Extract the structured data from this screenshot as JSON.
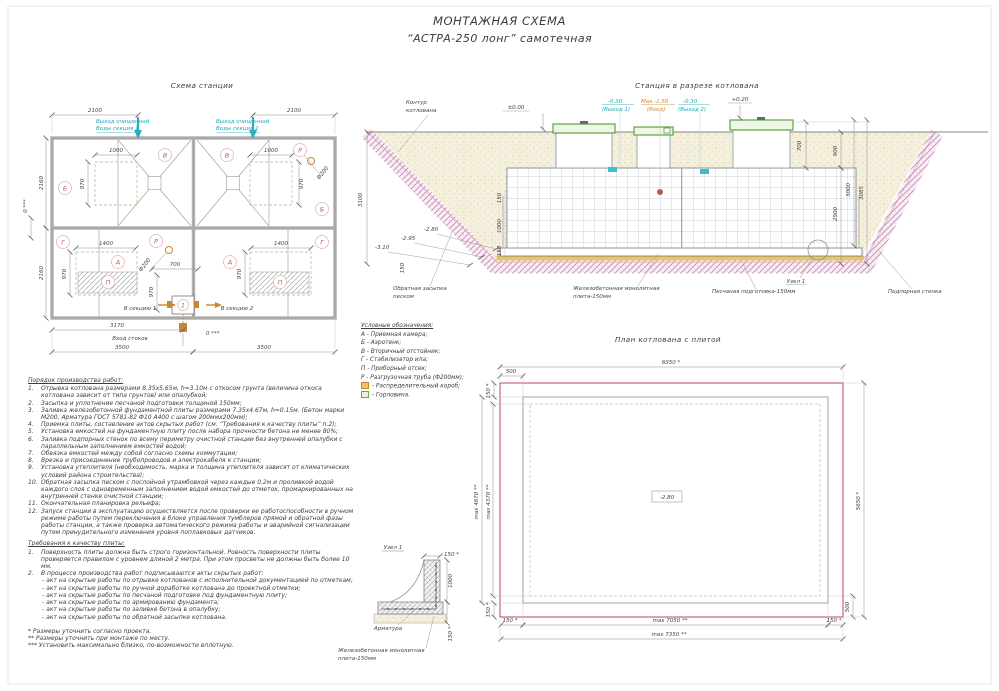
{
  "title": {
    "line1": "МОНТАЖНАЯ СХЕМА",
    "line2": "“АСТРА-250 лонг” самотечная"
  },
  "scheme": {
    "heading": "Схема станции",
    "dim_2100_left": "2100",
    "dim_2100_right": "2100",
    "outlet1_l1": "Выход очищенной",
    "outlet1_l2": "Воды секция 1",
    "outlet2_l1": "Выход очищенной",
    "outlet2_l2": "Воды секция 2",
    "dim_2160_top": "2160",
    "dim_2160_bottom": "2160",
    "dim_0_left": "0 ***",
    "dim_1000_l": "1000",
    "dim_1000_r": "1000",
    "dim_970_tl": "970",
    "dim_970_tr": "970",
    "dim_970_bl": "970",
    "dim_970_br": "970",
    "dim_970_c": "970",
    "dim_1400_l": "1400",
    "dim_1400_r": "1400",
    "dim_700": "700",
    "phi200_top": "Ф200",
    "phi200_bottom": "Ф200",
    "letters": {
      "B_l": "Б",
      "V_l": "В",
      "V_r": "В",
      "B_r": "Б",
      "R_t": "Р",
      "G_l": "Г",
      "A_l": "А",
      "P_l": "П",
      "A_r": "А",
      "G_r": "Г",
      "P_r": "П",
      "R_b": "Р",
      "one": "1"
    },
    "to_section1": "В секцию 1",
    "to_section2": "В секцию 2",
    "dim_3170": "3170",
    "inlet": "Вход стоков",
    "dim_0_bottom": "0 ***",
    "dim_3500_l": "3500",
    "dim_3500_r": "3500"
  },
  "section": {
    "heading": "Станция в разрезе котлована",
    "contour_l1": "Контур",
    "contour_l2": "котлована",
    "elev_000": "±0.00",
    "out1_l1": "-0.30",
    "out1_l2": "(Выход 1)",
    "inlet_l1": "Мах.-1.50",
    "inlet_l2": "(Вход)",
    "out2_l1": "-0.30",
    "out2_l2": "(Выход 2)",
    "elev_020": "+0.20",
    "dim_700": "700",
    "dim_900": "900",
    "dim_2900": "2900",
    "dim_3000": "3000",
    "dim_3085": "3085",
    "dim_3100": "3100",
    "elev_280": "-2.80",
    "elev_295": "-2.95",
    "elev_310": "-3.10",
    "dim_150_left": "150",
    "dim_150_a": "150",
    "dim_1000": "1000",
    "dim_150_b": "150",
    "backfill_l1": "Обратная засыпка",
    "backfill_l2": "песком",
    "slab_l1": "Железобетонная монолитная",
    "slab_l2": "плита-150мм",
    "sandprep": "Песчаная подготовка-150мм",
    "wall": "Подпорная стенка",
    "node_ref": "Узел 1"
  },
  "legend": {
    "heading": "Условные обозначения:",
    "items": [
      "А  -  Приемная камера;",
      "Б  -  Аэротенк;",
      "В  -  Вторичный отстойник;",
      "Г  -  Стабилизатор ила;",
      "П  -  Приборный отсек;",
      "Р  -  Разгрузочная труба (Ф200мм);"
    ],
    "box_item": "-  Распределительный короб;",
    "neck_item": "-  Горловина."
  },
  "plan": {
    "heading": "План котлована с плитой",
    "dim_8350": "8350 *",
    "dim_500_top": "500",
    "dim_150_tl": "150 *",
    "dim_4670": "max 4670 **",
    "dim_4370": "max 4370 **",
    "dim_150_bl": "150 *",
    "dim_5650": "5650 *",
    "dim_500_right": "500",
    "elev": "-2.80",
    "dim_150_b1": "150 *",
    "dim_7050": "max 7050 **",
    "dim_150_b2": "150 *",
    "dim_7350": "max 7350 **"
  },
  "node": {
    "heading": "Узел 1",
    "dim_150_top": "150 *",
    "dim_1000": "1000",
    "dim_150_right": "150 *",
    "rebar": "Арматура",
    "slab_l1": "Железобетонная монолитная",
    "slab_l2": "плита-150мм"
  },
  "procedure": {
    "heading": "Порядок производства работ:",
    "items": [
      {
        "n": "1.",
        "t": "Отрывка котлована размерами 8.35х5.65м, h=3.10м с откосом грунта (величина откоса котлована зависит от типа грунтов) или опалубкой;"
      },
      {
        "n": "2.",
        "t": "Засыпка и уплотнение песчаной подготовки толщиной 150мм;"
      },
      {
        "n": "3.",
        "t": "Заливка железобетонной фундаментной плиты размерами 7.35х4.67м, h=0.15м. (Бетон марки М200, Арматура ГОСТ 5781-82 Ф10 А400 с шагом 200ммх200мм);"
      },
      {
        "n": "4.",
        "t": "Приемка плиты, составление актов скрытых работ (см. “Требования к качеству плиты” п.2);"
      },
      {
        "n": "5.",
        "t": "Установка емкостей на фундаментную плиту после набора прочности бетона не менее 80%;"
      },
      {
        "n": "6.",
        "t": "Заливка подпорных стенок по всему периметру очистной станции без внутренней опалубки с параллельным заполнением емкостей водой;"
      },
      {
        "n": "7.",
        "t": "Обвязка емкостей между собой согласно схемы коммутации;"
      },
      {
        "n": "8.",
        "t": "Врезка и присоединение трубопроводов и электрокабеля к станции;"
      },
      {
        "n": "9.",
        "t": "Установка утеплителя (необходимость, марка и толщина утеплителя зависят от климатических условий района строительства);"
      },
      {
        "n": "10.",
        "t": "Обратная засыпка песком с послойной утрамбовкой через каждые 0.2м и проливкой водой каждого слоя с одновременным заполнением водой емкостей до отметок, промаркированных на внутренней стенке очистной станции;"
      },
      {
        "n": "11.",
        "t": "Окончательная планировка рельефа;"
      },
      {
        "n": "12.",
        "t": "Запуск станции в эксплуатацию осуществляется после проверки ее работоспособности в ручном режиме работы путем переключения в блоке управления тумблеров прямой и обратной фазы работы станции, а также проверка автоматического режима работы и аварийной сигнализации путем принудительного изменения уровня поплавковых датчиков."
      }
    ]
  },
  "requirements": {
    "heading": "Требования к качеству плиты:",
    "item1_n": "1.",
    "item1": "Поверхность плиты должна быть строго горизонтальной. Ровность поверхности плиты проверяется правилом с уровнем длиной 2 метра. При этом просветы не должны быть более 10 мм.",
    "item2_n": "2.",
    "item2": "В процессе производства работ подписываются акты скрытых работ:",
    "acts": [
      "- акт на скрытые работы по отрывке котлованов с исполнительной документацией по отметкам;",
      "- акт на скрытые работы по ручной доработке котлована до проектной отметки;",
      "- акт на скрытые работы по песчаной подготовке под фундаментную плиту;",
      "- акт на скрытые работы по армированию фундамента;",
      "- акт на скрытые работы по заливке бетона в опалубку;",
      "- акт на скрытые работы по обратной засыпке котлована."
    ]
  },
  "footnotes": [
    "* Размеры уточнить согласно проекта.",
    "** Размеры уточнить при монтаже по месту.",
    "*** Установить максимально близко, по-возможности вплотную."
  ],
  "colors": {
    "accent_red": "#c25663",
    "cyan": "#1ea7b6",
    "orange": "#c6862c",
    "green": "#5aa542"
  }
}
